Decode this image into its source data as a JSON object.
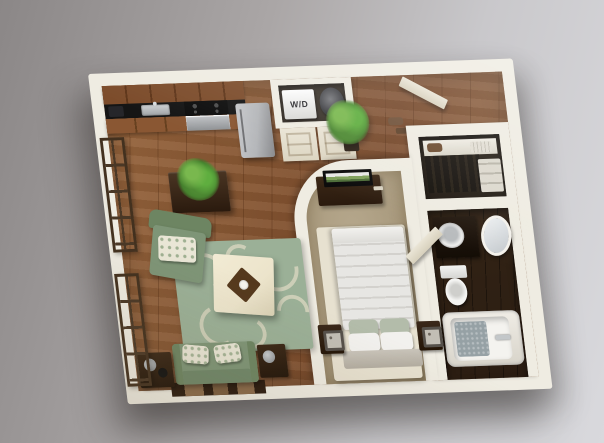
{
  "scene": {
    "type": "3d-floorplan-render",
    "view": "isometric top-down apartment on gray studio backdrop"
  },
  "labels": {
    "washer_dryer": "W/D"
  },
  "palette": {
    "bg1": "#8b8787",
    "bg2": "#aaa6a6",
    "bg3": "#c9c8cb",
    "bg4": "#d9d9dd",
    "wall": "#efece2",
    "wallshade": "#d9d3c2",
    "wood": "#96653d",
    "wood2": "#7a4a2a",
    "cab": "#7c4c2b",
    "counter": "#151515",
    "steel": "#b4b6b9",
    "closetdark": "#3a332b",
    "doorcream": "#eae5d6",
    "carpet": "#b6a88d",
    "carpet2": "#a39477",
    "rugcream": "#e7e1d0",
    "rugsage": "#9bb097",
    "swirl": "#d9d6c0",
    "green": "#7e9577",
    "green2": "#6d8562",
    "ottoman": "#ece4cb",
    "darkwood": "#3b2817",
    "darkwood2": "#2a1a0e",
    "white": "#f2f1ee",
    "duvet": "#e7e6e3",
    "pleat": "#d3d1cd",
    "headboard": "#c9c4ba",
    "sagepillow": "#b3bcaa",
    "bathfloor": "#2b1d12",
    "porcelain": "#f4f3ef",
    "mat": "#96a1a5",
    "chrome": "#c3c7c9",
    "plant": "#4e8a33",
    "plant2": "#79b84e",
    "pot": "#2e2218",
    "lamp": "#c2beb5",
    "lampframe": "#55504a",
    "wdtext": "#2e2e32"
  },
  "rooms": [
    {
      "id": "living-room",
      "floor": "hardwood",
      "items": [
        "sofa",
        "throw-pillows",
        "armchair",
        "floral-area-rug",
        "ottoman-coffee-table",
        "serving-tray",
        "side-table-left",
        "side-table-right",
        "table-lamps",
        "plant-table",
        "potted-plant",
        "windows",
        "media-console"
      ]
    },
    {
      "id": "kitchen",
      "floor": "hardwood",
      "items": [
        "upper-cabinets",
        "countertop",
        "sink",
        "toaster",
        "cooktop",
        "oven",
        "refrigerator",
        "lower-cabinets"
      ]
    },
    {
      "id": "laundry-closet",
      "floor": "concrete",
      "items": [
        "washer-dryer",
        "water-heater",
        "double-closet-doors"
      ]
    },
    {
      "id": "entry-hall",
      "floor": "hardwood",
      "items": [
        "front-door",
        "potted-plant",
        "shoes"
      ]
    },
    {
      "id": "bedroom",
      "floor": "carpet",
      "items": [
        "bed",
        "duvet",
        "pillows",
        "headboard",
        "nightstand-left",
        "nightstand-right",
        "square-lamps",
        "tv-console",
        "tv",
        "remote",
        "cream-area-rug",
        "curved-wall",
        "door"
      ]
    },
    {
      "id": "walk-in-closet",
      "floor": "dark",
      "items": [
        "shelf",
        "clutch",
        "ribbed-box",
        "hanging-clothes",
        "storage-baskets"
      ]
    },
    {
      "id": "bathroom",
      "floor": "dark-wood",
      "items": [
        "vanity",
        "sink",
        "mirror",
        "toilet",
        "bathtub",
        "bath-mat",
        "faucet"
      ]
    }
  ]
}
